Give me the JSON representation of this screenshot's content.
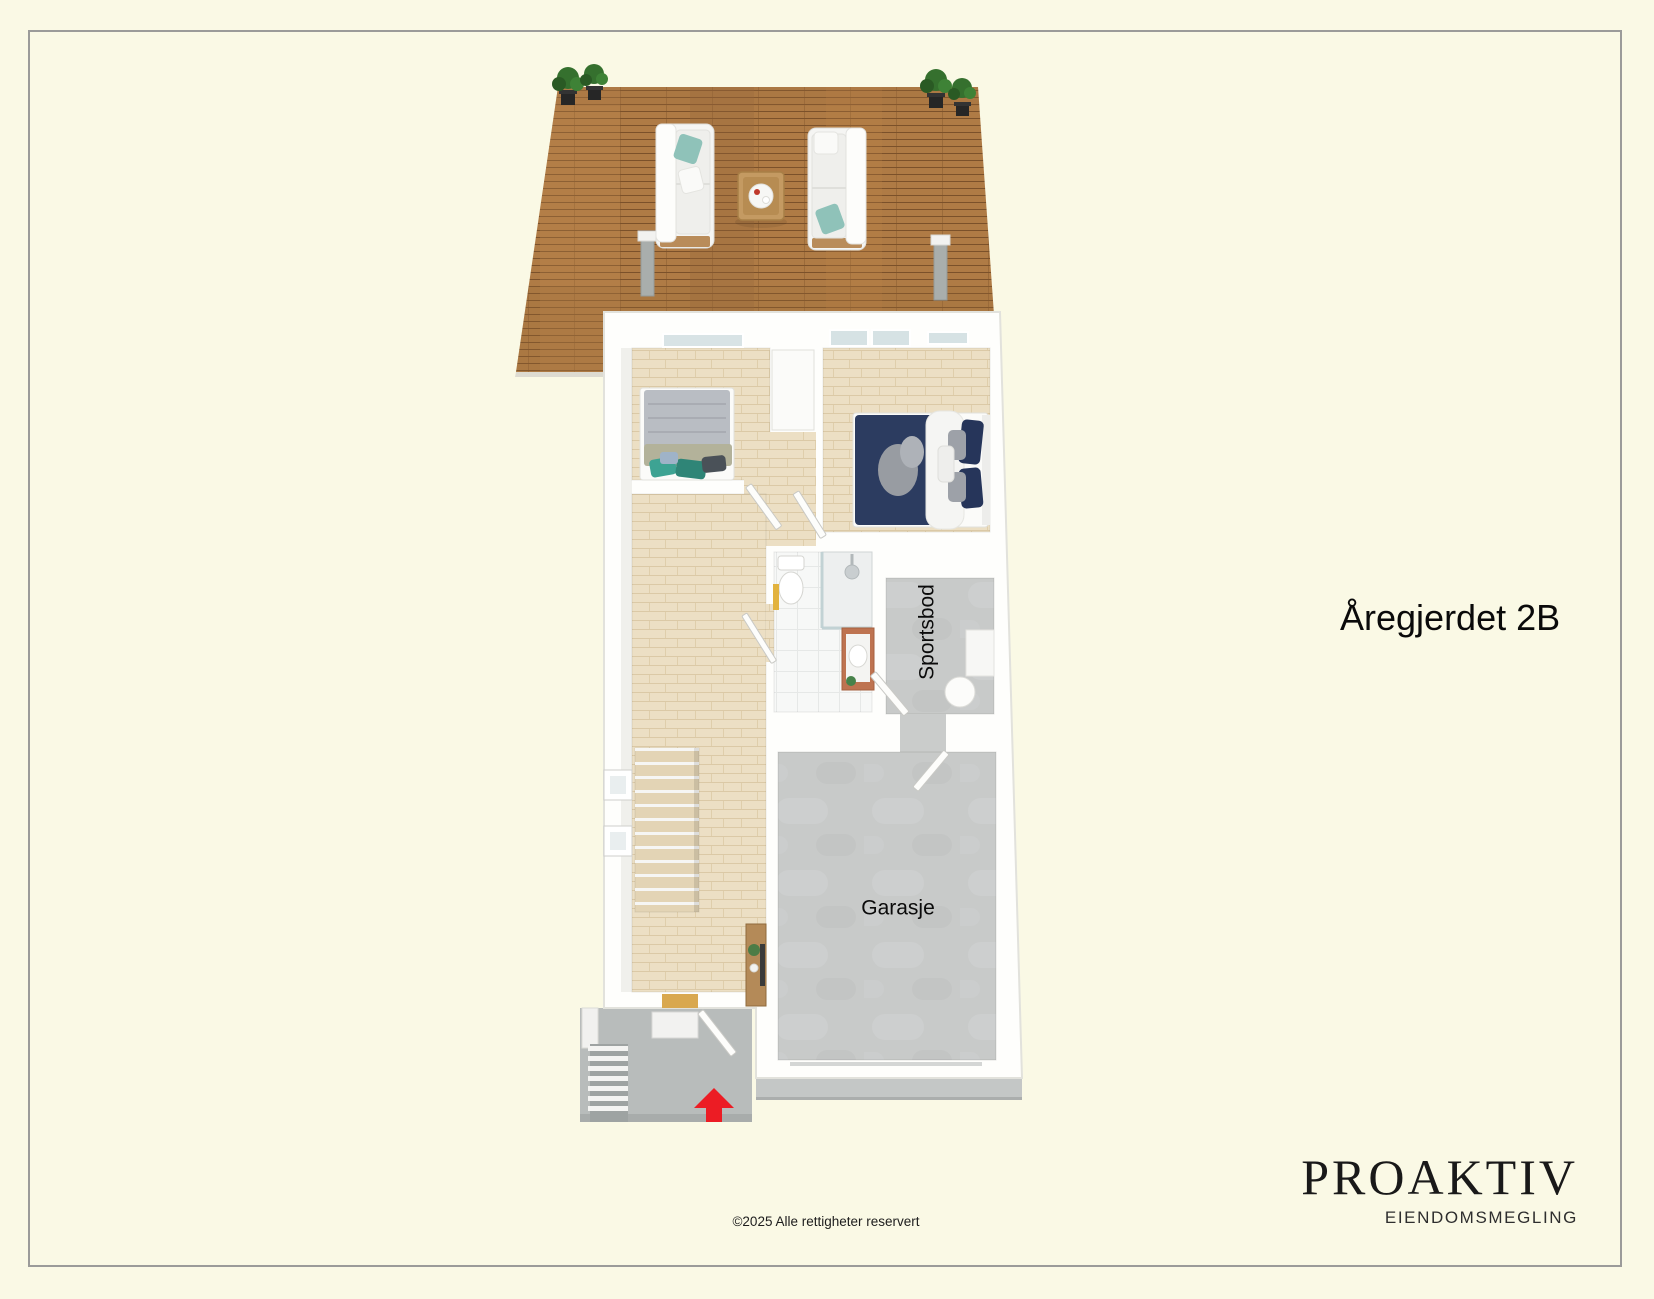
{
  "canvas": {
    "width": 1654,
    "height": 1299,
    "background_color": "#FAF9E5",
    "frame_border_color": "#9B9B99"
  },
  "title": "Åregjerdet 2B",
  "plan": {
    "labels": {
      "storage": "Sportsbod",
      "garage": "Garasje"
    },
    "colors": {
      "deck_wood": "#AF7B45",
      "deck_plank_line": "#7E5427",
      "parquet": "#ECDFC4",
      "concrete": "#C8CAC9",
      "porch_concrete": "#B8BCBB",
      "wall_white": "#FEFEFC",
      "entrance_arrow": "#EC1C24",
      "pillow_teal": "#4FA393",
      "bed_navy": "#2C3C60",
      "vanity_terracotta": "#BE7350",
      "plant_green": "#35702E"
    }
  },
  "footer": {
    "copyright": "©2025 Alle rettigheter reservert"
  },
  "brand": {
    "name": "PROAKTIV",
    "tagline": "EIENDOMSMEGLING"
  }
}
